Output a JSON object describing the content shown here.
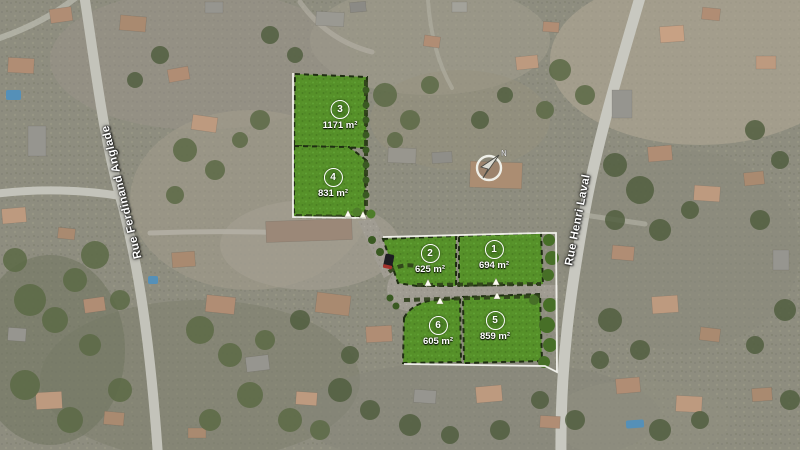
{
  "map": {
    "streets": [
      {
        "name": "Rue Ferdinand Anglade"
      },
      {
        "name": "Rue Henri Laval"
      }
    ],
    "compass": {
      "north_label": "N"
    },
    "lots": [
      {
        "number": "1",
        "area": "694 m²"
      },
      {
        "number": "2",
        "area": "625 m²"
      },
      {
        "number": "3",
        "area": "1171 m²"
      },
      {
        "number": "4",
        "area": "831 m²"
      },
      {
        "number": "5",
        "area": "859 m²"
      },
      {
        "number": "6",
        "area": "605 m²"
      }
    ],
    "colors": {
      "parcel_green": "#569129",
      "hedge_dark": "#2e3f1a",
      "boundary_white": "#f5f5f0",
      "road_grey": "#a09c92"
    }
  }
}
